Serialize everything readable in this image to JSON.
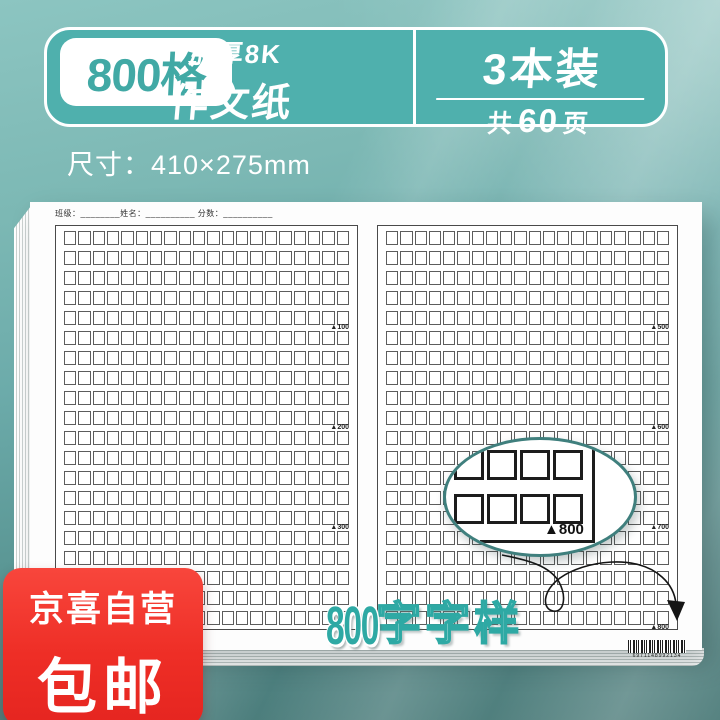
{
  "banner": {
    "grid_count": "800格",
    "type_line1": "加厚8K",
    "type_line2": "作文纸",
    "pack_count": "3本装",
    "pages_prefix": "共",
    "pages_count": "60",
    "pages_suffix": "页"
  },
  "size_label": "尺寸：410×275mm",
  "paper": {
    "header": "班级：________姓名：__________ 分数：__________",
    "rows": 20,
    "columns": 20,
    "pages": [
      {
        "side": "left",
        "markers": {
          "5": "▲100",
          "10": "▲200",
          "15": "▲300",
          "20": "▲400"
        }
      },
      {
        "side": "right",
        "markers": {
          "5": "▲500",
          "10": "▲600",
          "15": "▲700",
          "20": "▲800"
        }
      }
    ],
    "barcode": "6971148992134"
  },
  "magnifier": {
    "label": "▲800"
  },
  "watermark": {
    "number": "800",
    "suffix": "字字样"
  },
  "promo": {
    "store": "京喜自营",
    "shipping": "包邮"
  },
  "colors": {
    "teal": "#4fb0ad",
    "teal_dark": "#3f7f7d",
    "red": "#ee2e26",
    "bg_top": "#8cc5c1",
    "bg_bottom": "#487876"
  }
}
